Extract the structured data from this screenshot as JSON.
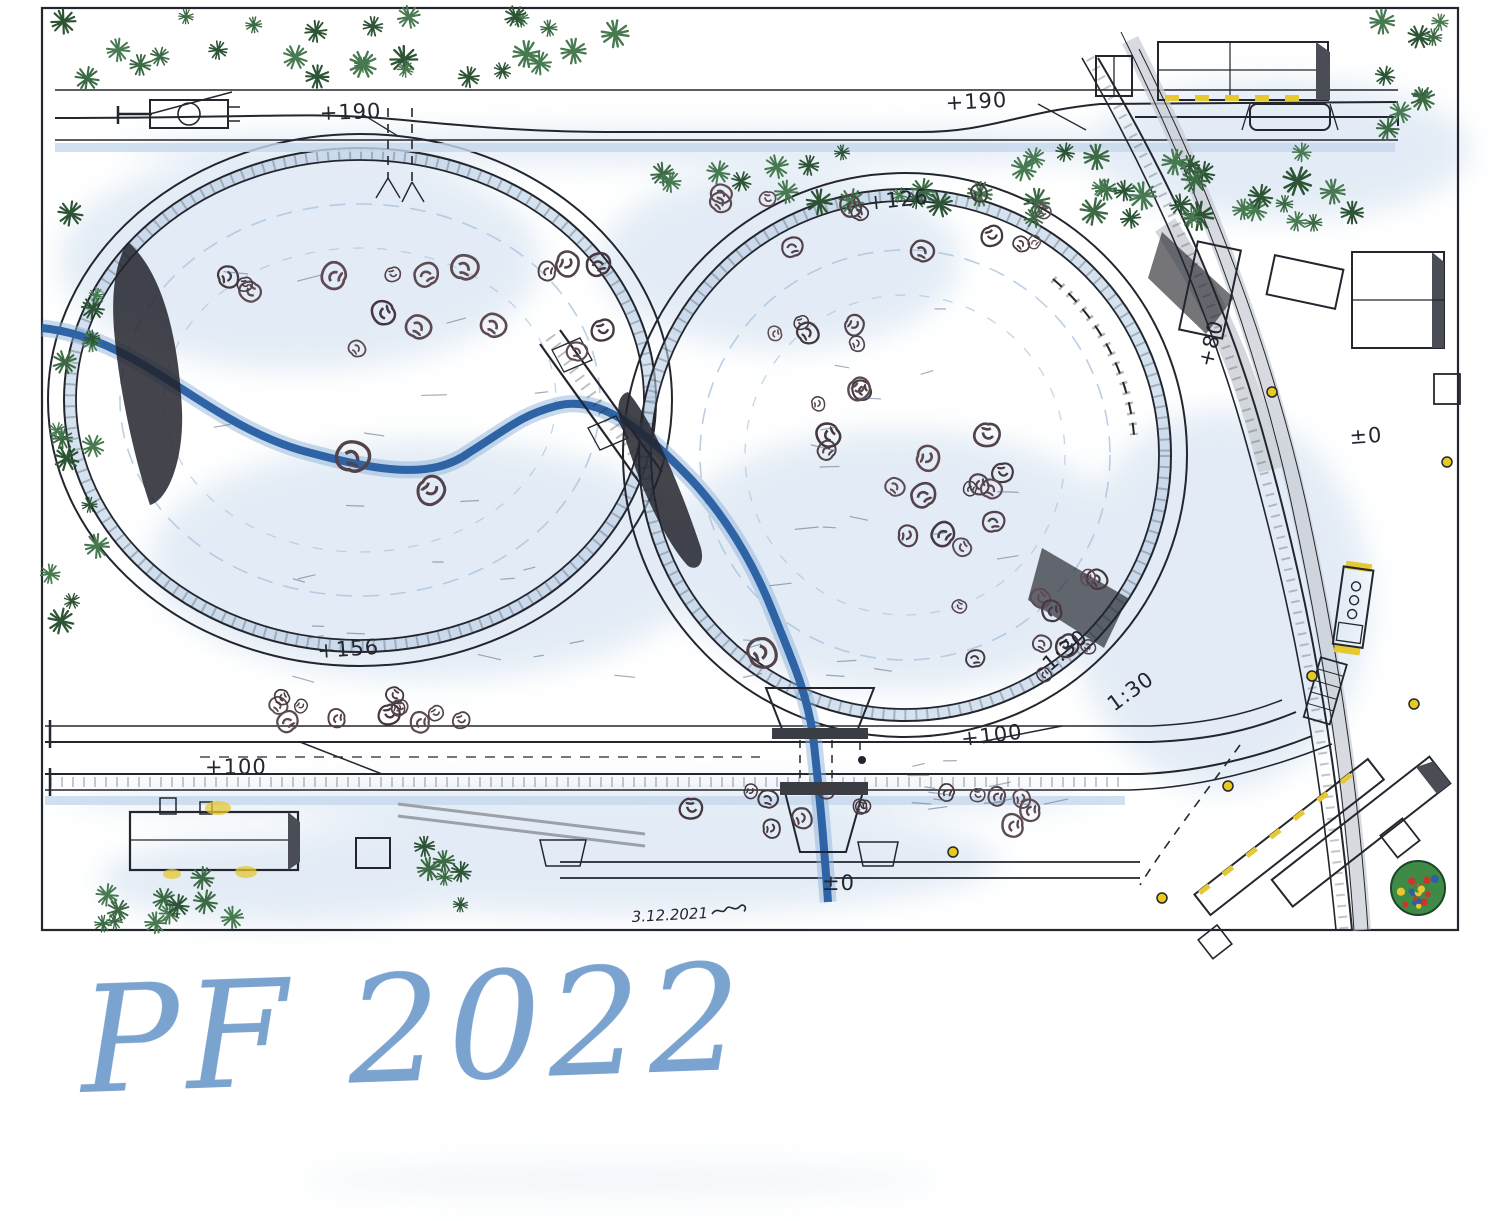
{
  "card": {
    "greeting": "PF 2022",
    "greeting_color": "#7ba3cf",
    "date": "3.12.2021"
  },
  "plan": {
    "elevation_labels": [
      {
        "id": "top-yard-left",
        "text": "+190"
      },
      {
        "id": "top-yard-right",
        "text": "+190"
      },
      {
        "id": "right-loop-top",
        "text": "+126"
      },
      {
        "id": "right-curve-vertical",
        "text": "+80"
      },
      {
        "id": "right-edge",
        "text": "±0"
      },
      {
        "id": "left-loop",
        "text": "+156"
      },
      {
        "id": "bottom-curve-right",
        "text": "+100"
      },
      {
        "id": "bottom-yard-left",
        "text": "+100"
      },
      {
        "id": "bottom-center",
        "text": "±0"
      }
    ],
    "gradient_labels": [
      "1:30",
      "1:30"
    ],
    "colors": {
      "ink": "#23262e",
      "snow_shade": "#cdddee",
      "river": "#2e63a5",
      "river_halo": "#8fb3da",
      "pine": "#3c6a44",
      "pine_dark": "#2c5435",
      "bare_tree": "#53424a",
      "accent_yellow": "#e6c832",
      "road": "#c9ced4",
      "rock": "#23242c",
      "ornament_red": "#cf342c",
      "ornament_blue": "#2e5fa3",
      "ornament_green": "#3f8a46",
      "greeting": "#7ba3cf"
    }
  }
}
